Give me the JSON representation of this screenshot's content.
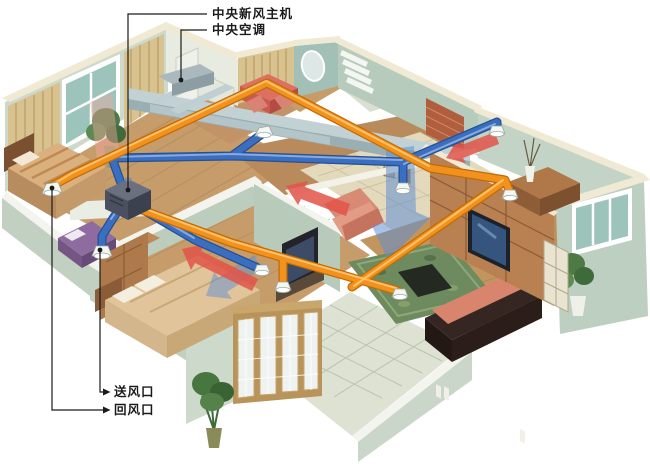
{
  "diagram": {
    "type": "isometric-hvac-cutaway-apartment",
    "labels": {
      "fresh_air_unit": "中央新风主机",
      "central_ac": "中央空调",
      "supply_vent": "送风口",
      "return_vent": "回风口"
    },
    "colors": {
      "supply_duct": "#f2921d",
      "supply_duct_dark": "#c06c06",
      "return_duct": "#3a6ec0",
      "return_duct_dark": "#27508f",
      "airflow_warm": "#e25449",
      "airflow_cool": "#5e8fd2",
      "unit_body": "#4a5060",
      "leader_line": "#1a1a1a",
      "wall_top": "#f0ead4",
      "wall_face": "#c8d6c8",
      "wood_floor": "#c79c6b"
    }
  }
}
